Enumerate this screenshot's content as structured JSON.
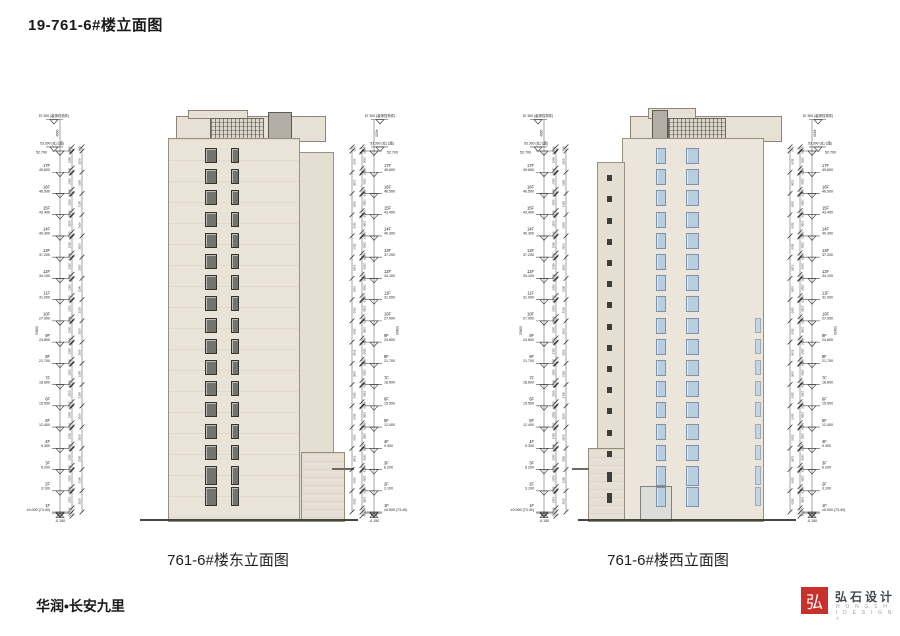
{
  "page": {
    "title": "19-761-6#楼立面图",
    "footer_project": "华润•长安九里",
    "logo": {
      "mark": "弘",
      "name_cn": "弘石设计",
      "name_en": "H O N G S H I   D E S I G N +"
    }
  },
  "drawings": [
    {
      "caption": "761-6#楼东立面图"
    },
    {
      "caption": "761-6#楼西立面图"
    }
  ],
  "levels": {
    "decor_top": {
      "elev": "57.300",
      "note": "(装饰性构件)"
    },
    "parapet": {
      "elev": "53.300",
      "note": "(女儿墙)"
    },
    "roof_dim": "4000",
    "total_dim": "53400",
    "floor_dim": "3100",
    "head_dim": "150",
    "window_dim": "2350",
    "sill_dim": "600",
    "below_ground": "-0.150",
    "floors": [
      {
        "label": "17F",
        "elev": "49.600",
        "h": 49.6,
        "top_elev": "52.700",
        "top_h": 52.7
      },
      {
        "label": "16F",
        "elev": "46.500",
        "h": 46.5
      },
      {
        "label": "15F",
        "elev": "43.400",
        "h": 43.4
      },
      {
        "label": "14F",
        "elev": "40.300",
        "h": 40.3
      },
      {
        "label": "13F",
        "elev": "37.200",
        "h": 37.2
      },
      {
        "label": "12F",
        "elev": "34.100",
        "h": 34.1
      },
      {
        "label": "11F",
        "elev": "31.000",
        "h": 31.0
      },
      {
        "label": "10F",
        "elev": "27.900",
        "h": 27.9
      },
      {
        "label": "9F",
        "elev": "24.800",
        "h": 24.8
      },
      {
        "label": "8F",
        "elev": "21.700",
        "h": 21.7
      },
      {
        "label": "7F",
        "elev": "18.600",
        "h": 18.6
      },
      {
        "label": "6F",
        "elev": "15.500",
        "h": 15.5
      },
      {
        "label": "5F",
        "elev": "12.400",
        "h": 12.4
      },
      {
        "label": "4F",
        "elev": "9.300",
        "h": 9.3
      },
      {
        "label": "3F",
        "elev": "6.200",
        "h": 6.2
      },
      {
        "label": "2F",
        "elev": "3.100",
        "h": 3.1
      },
      {
        "label": "1F",
        "elev": "±0.000 (73.40)",
        "h": 0
      }
    ]
  },
  "colors": {
    "accent_red": "#c9302c",
    "facade_cream": "#eae3d8",
    "facade_warm": "#ece5dc",
    "window_glass_blue": "#b7cde0",
    "window_dark": "#74746c",
    "line": "#444444"
  }
}
